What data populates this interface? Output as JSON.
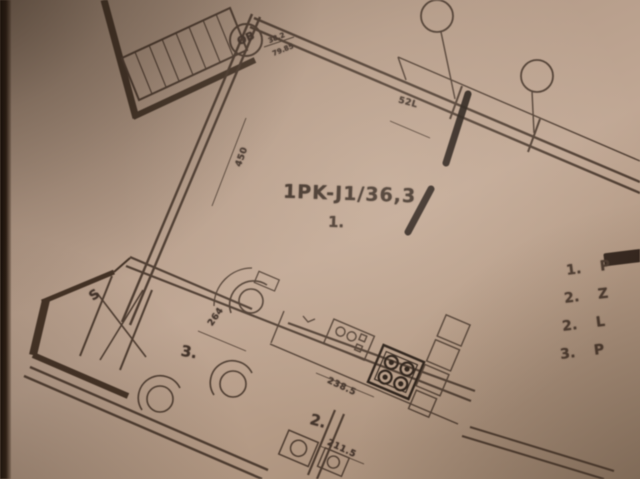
{
  "photo": {
    "paper_color": "#b49b88",
    "ink_color": "#43342a",
    "marker_color": "#17100b",
    "shadow_color": "#23180f"
  },
  "stamp": {
    "circle_label": "OB",
    "value_top": "38.2",
    "value_bottom": "79.85"
  },
  "plan": {
    "unit_title": "1PK-J1/36,3",
    "unit_room_number": "1.",
    "room_labels": {
      "bathroom": "3.",
      "bedroom": "2."
    },
    "wing_label": "S",
    "dimensions": {
      "top_wall": "52L",
      "west_wall": "450",
      "hall": "264",
      "kitchen": "238.5",
      "bottom_room": "211.5"
    }
  },
  "legend": {
    "items": [
      {
        "num": "1.",
        "text": "P"
      },
      {
        "num": "2.",
        "text": "Z"
      },
      {
        "num": "2.",
        "text": "L"
      },
      {
        "num": "3.",
        "text": "P"
      }
    ]
  }
}
